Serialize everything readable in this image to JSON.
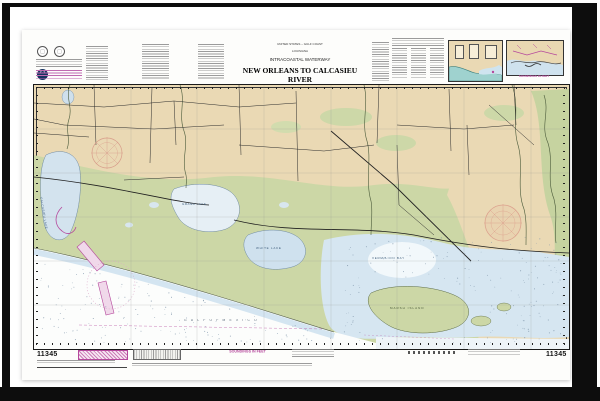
{
  "chart": {
    "number": "11345",
    "title_block": {
      "country": "UNITED STATES – GULF COAST",
      "state": "LOUISIANA",
      "series": "INTRACOASTAL WATERWAY",
      "title": "NEW ORLEANS TO CALCASIEU RIVER",
      "section": "WEST SECTION",
      "details": [
        "Mercator Projection",
        "Scale 1:80,000 at Lat 29°30'",
        "North American Datum of 1983",
        "(World Geodetic System 1984)"
      ]
    },
    "soundings_label": "SOUNDINGS IN FEET",
    "inset_caption": "SOUNDINGS IN FEET",
    "map_labels": {
      "calcasieu_lake": "CALCASIEU LAKE",
      "grand_lake": "GRAND LAKE",
      "white_lake": "WHITE LAKE",
      "vermilion_bay": "VERMILION BAY",
      "marsh_island": "MARSH ISLAND",
      "gulf": "G U L F   O F   M E X I C O"
    },
    "colors": {
      "land": "#ead9b4",
      "marsh": "#ccd7a6",
      "shallow_water": "#d6e6f1",
      "magenta": "#b5489c",
      "compass_rose": "#d89c8a",
      "frame": "#0d0d0d"
    }
  }
}
